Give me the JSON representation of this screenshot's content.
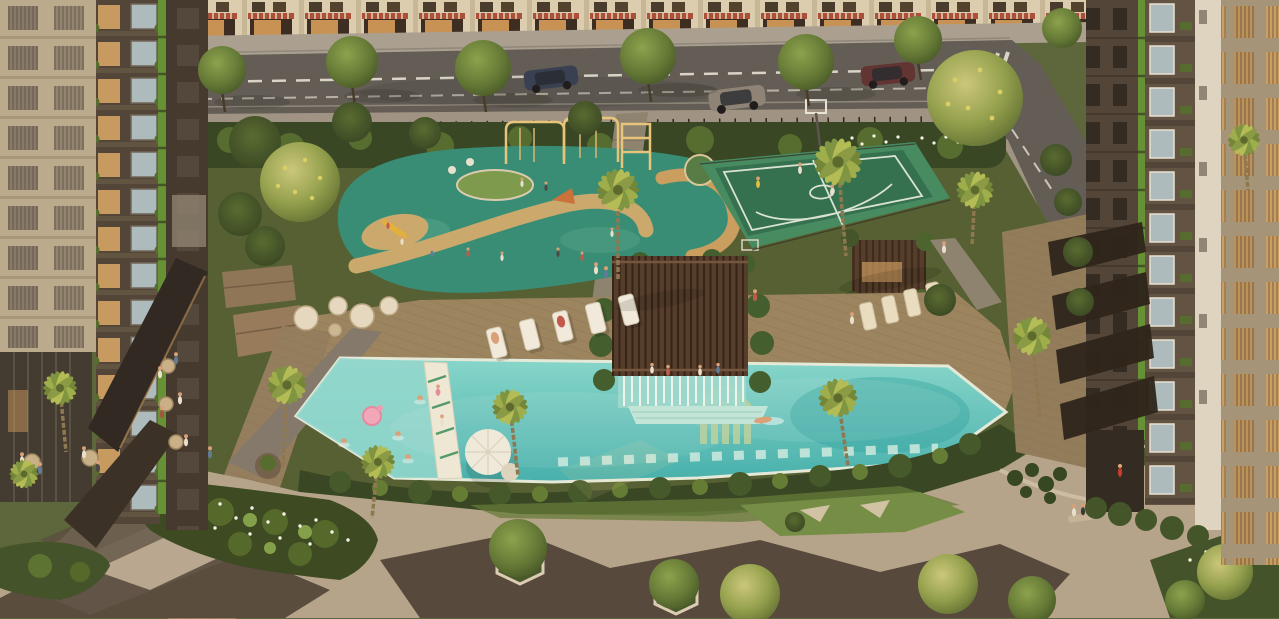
{
  "scene": {
    "title": "Aerial golden-hour rendering of a residential complex amenity courtyard",
    "setting": "landscaped podium between two apartment towers facing a shophouse street",
    "features": [
      "shophouse retail street with cars and street trees",
      "left dark residential tower with green accent stripe and balconies",
      "left beige slatted tower",
      "right dark residential tower with green accent stripe",
      "right white and beige towers",
      "children playground with golden play frames",
      "basketball half court with players",
      "resort style swimming pool with mosaic logo",
      "kids pool with pink flamingo float",
      "white pool bridge with umbrella",
      "swim-up pergola bar with waterfall curtain",
      "rows of sun loungers and wicker seats",
      "cafe terrace with round tables and guests",
      "geometric stone plaza with hexagonal tree planters",
      "garden paths with white flower beds, bench and jogger",
      "palm trees around the pool"
    ],
    "counts": {
      "palm_trees": 11,
      "sun_loungers": 9,
      "cars": 3,
      "basketball_players": 3,
      "pool_swimmers": 6,
      "cafe_tables": 6,
      "hex_planters": 2,
      "street_trees": 6
    }
  },
  "colors": {
    "shophouseWall": "#dbcfb4",
    "awningRed": "#a64a36",
    "asphalt": "#5b5955",
    "sidewalk": "#a79f92",
    "sidewalkLower": "#9b9285",
    "amenityGreen": "#4d5c30",
    "playgroundTeal": "#2f8c77",
    "sandPath": "#c9a96d",
    "courtGreen": "#2b6e4e",
    "courtApron": "#3f8a60",
    "deckWood": "#97825f",
    "terraceWood": "#8d7a60",
    "poolLight": "#82d8d0",
    "poolDeep": "#3fb1b0",
    "kidsPool": "#8fd9d2",
    "poolCoping": "#e3ecdf",
    "pergolaRoof": "#4e382a",
    "waterfallWhite": "#f4fbf7",
    "hedgeDark": "#2f4222",
    "bedDark": "#33451f",
    "pavingLight": "#b3a48d",
    "pavingDark": "#4a4036",
    "stonePath": "#7e776b",
    "towerBeige": "#b9aa90",
    "towerDark": "#4a4137",
    "accentGreen": "#5f9033",
    "rightTowerDark": "#4a4036",
    "rightTowerMid": "#5a4e42",
    "rightTowerLight": "#ddd6c6",
    "rightTowerBeige": "#a2937b",
    "flowerWhite": "#f4f6ec",
    "palmLight": "#9aad4a",
    "palmDark": "#6d8436",
    "loungerCream": "#f1ede0",
    "skin": "#d9a07a",
    "logoTile": "#b9d4a2",
    "grass": "#6f8c44"
  }
}
